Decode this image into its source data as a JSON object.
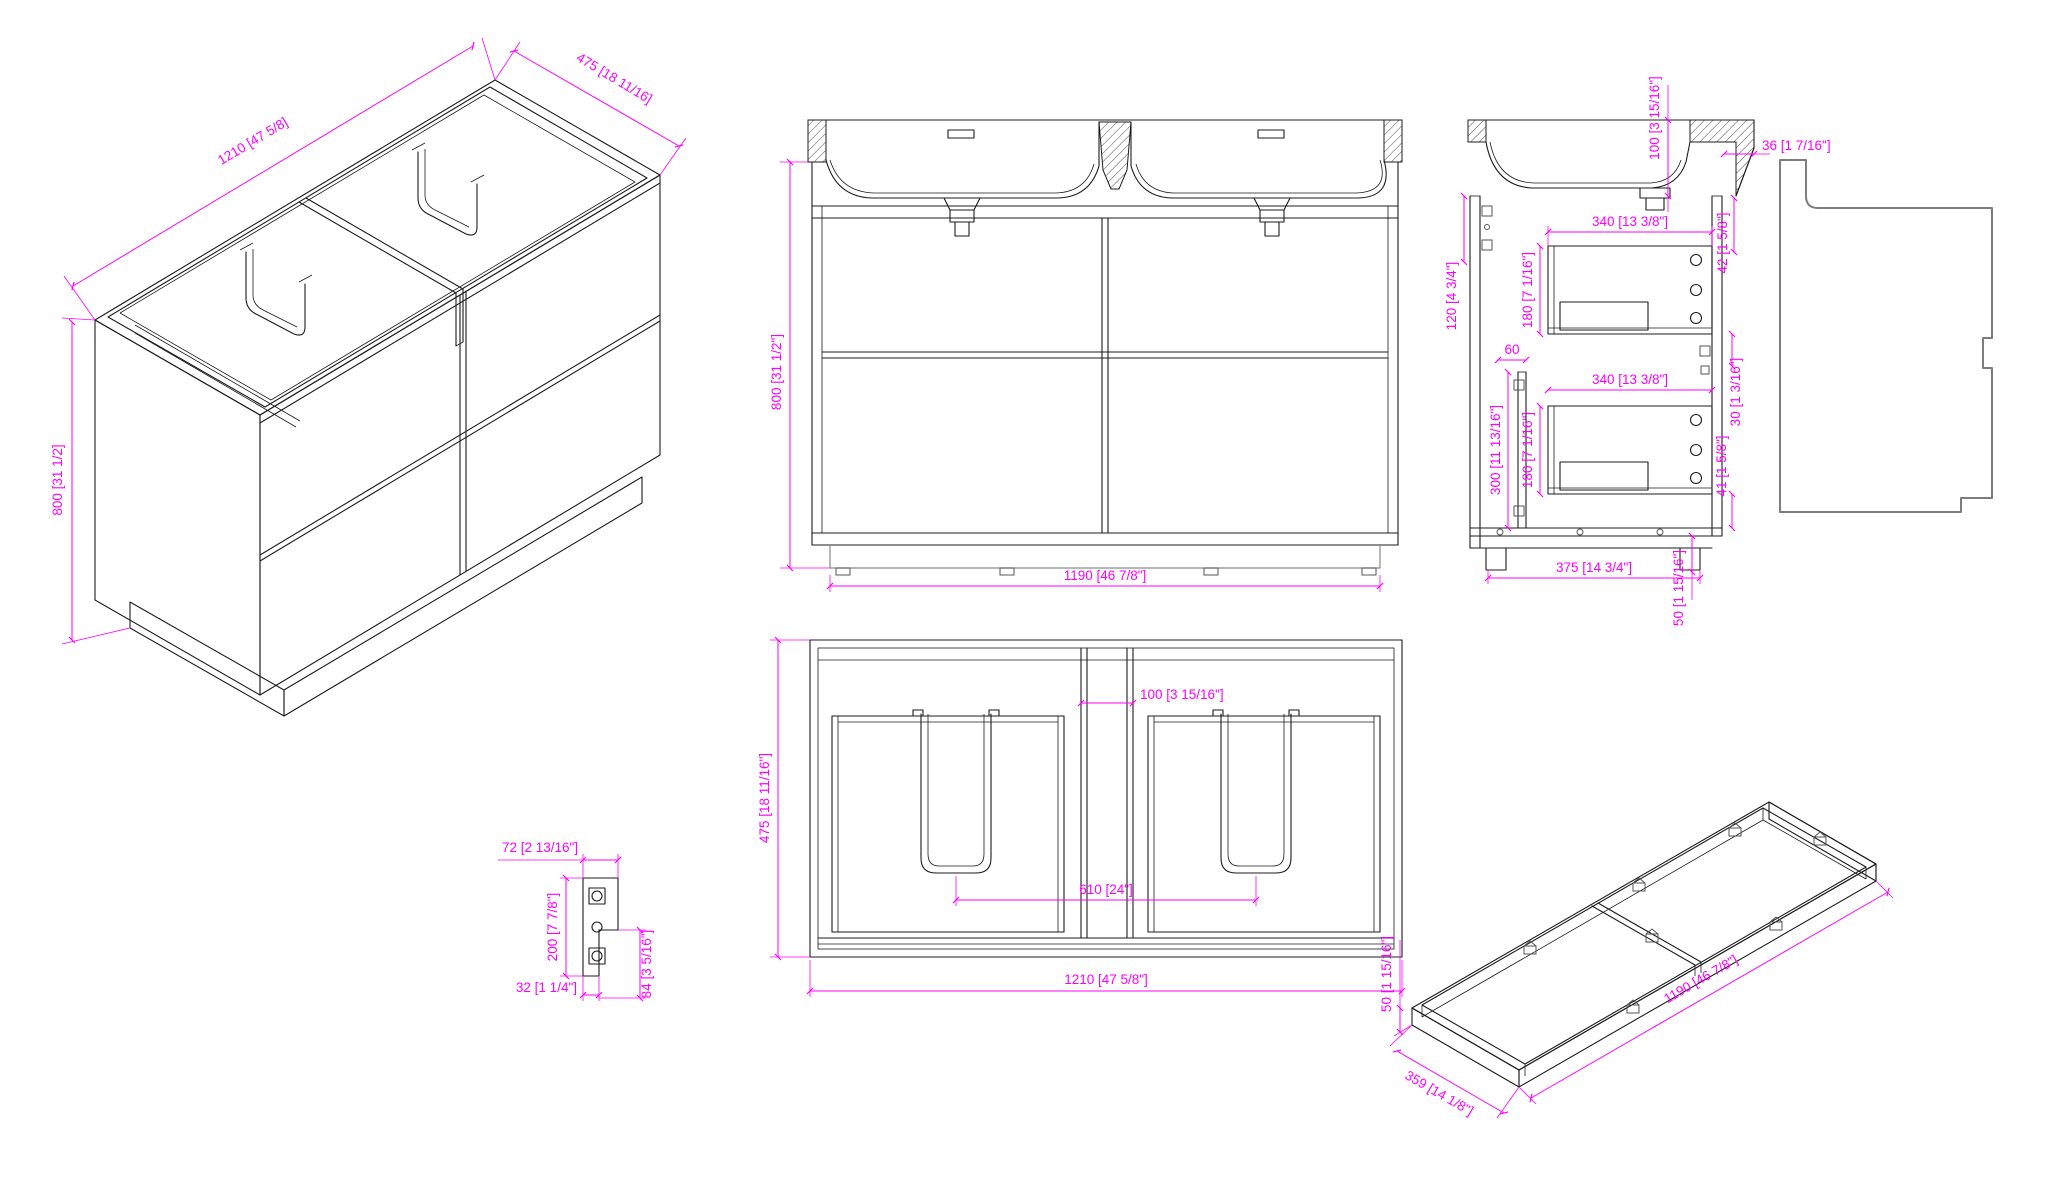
{
  "drawing": {
    "type": "cad-multiview-technical-drawing",
    "subject": "double-sink bathroom vanity cabinet",
    "dim_color": "#FF00FF",
    "line_color": "#1c1c1c",
    "panel_outline_color": "#7d7d7d",
    "views": {
      "isometric": {
        "title": "isometric-overview",
        "dims": {
          "width": "1210 [47 5/8]",
          "depth": "475 [18 11/16]",
          "height": "800 [31 1/2]"
        }
      },
      "front": {
        "title": "front-elevation",
        "dims": {
          "height": "800 [31 1/2\"]",
          "base_width": "1190 [46 7/8\"]"
        }
      },
      "side_section": {
        "title": "side-section",
        "dims": {
          "sink_depth": "100 [3 15/16\"]",
          "counter_overhang": "36 [1 7/16\"]",
          "top_clearance": "42 [1 5/8\"]",
          "back_rail_top": "120 [4 3/4\"]",
          "drawer1_depth": "340 [13 3/8\"]",
          "drawer1_height": "180 [7 1/16\"]",
          "rail_offset": "60",
          "back_rail_bottom": "300 [11 13/16\"]",
          "drawer2_height": "180 [7 1/16\"]",
          "drawer2_depth": "340 [13 3/8\"]",
          "mid_clearance": "30 [1 3/16\"]",
          "bottom_clearance": "41 [1 5/8\"]",
          "base_depth": "375 [14 3/4\"]",
          "plinth_height": "50 [1 15/16\"]"
        }
      },
      "plan": {
        "title": "bottom-plan",
        "dims": {
          "center_gap": "100 [3 15/16\"]",
          "depth": "475 [18 11/16\"]",
          "drain_spacing": "610 [24\"]",
          "width": "1210 [47 5/8\"]"
        }
      },
      "bracket_detail": {
        "title": "mounting-bracket-detail",
        "dims": {
          "width": "72 [2 13/16\"]",
          "height": "200 [7 7/8\"]",
          "foot_width": "32 [1 1/4\"]",
          "step_height": "84 [3 5/16\"]"
        }
      },
      "base_frame": {
        "title": "plinth-frame-isometric",
        "dims": {
          "length": "1190 [46 7/8\"]",
          "depth": "359 [14 1/8\"]",
          "height": "50 [1 15/16\"]"
        }
      }
    }
  }
}
